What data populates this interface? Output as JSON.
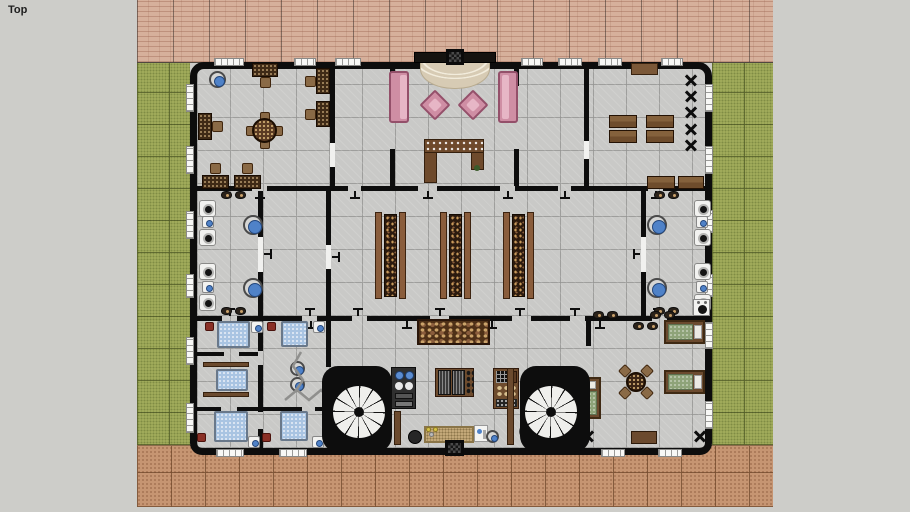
{
  "viewport": {
    "label": "Top",
    "background": "#cdcdc9"
  },
  "palette": {
    "background": "#cdcdc9",
    "wall": "#0d0d0d",
    "floor": "#c9c9c7",
    "grass": "#a6b05e",
    "brick": "#d6b09b",
    "paving": "#c69572",
    "sofa_pink": "#cf8ea4",
    "wood_brown": "#6b4a2e",
    "pool_blue": "#a9c4e2",
    "lounger_green": "#8ea379",
    "fixture_blue": "#4f82c8"
  },
  "plan": {
    "bands": {
      "brick": {
        "x": 137,
        "y": 0,
        "w": 636,
        "h": 63
      },
      "grass_left": {
        "x": 137,
        "y": 63,
        "w": 53,
        "h": 382
      },
      "grass_right": {
        "x": 712,
        "y": 63,
        "w": 61,
        "h": 382
      },
      "paving": {
        "x": 137,
        "y": 445,
        "w": 636,
        "h": 62
      }
    },
    "building": {
      "x": 190,
      "y": 62,
      "w": 522,
      "h": 393
    },
    "walls": [
      [
        197,
        186,
        55,
        5
      ],
      [
        267,
        186,
        81,
        5
      ],
      [
        361,
        186,
        57,
        5
      ],
      [
        437,
        186,
        63,
        5
      ],
      [
        515,
        186,
        43,
        5
      ],
      [
        571,
        186,
        77,
        5
      ],
      [
        663,
        186,
        42,
        5
      ],
      [
        197,
        316,
        25,
        5
      ],
      [
        237,
        316,
        65,
        5
      ],
      [
        317,
        316,
        35,
        5
      ],
      [
        367,
        316,
        63,
        5
      ],
      [
        449,
        316,
        63,
        5
      ],
      [
        531,
        316,
        39,
        5
      ],
      [
        585,
        316,
        67,
        5
      ],
      [
        667,
        316,
        38,
        5
      ],
      [
        330,
        67,
        5,
        76
      ],
      [
        330,
        167,
        5,
        19
      ],
      [
        390,
        62,
        5,
        24
      ],
      [
        390,
        149,
        5,
        37
      ],
      [
        514,
        62,
        5,
        24
      ],
      [
        514,
        149,
        5,
        37
      ],
      [
        584,
        67,
        5,
        74
      ],
      [
        584,
        159,
        5,
        27
      ],
      [
        258,
        191,
        5,
        46
      ],
      [
        258,
        272,
        5,
        44
      ],
      [
        326,
        191,
        5,
        54
      ],
      [
        326,
        269,
        5,
        47
      ],
      [
        641,
        191,
        5,
        46
      ],
      [
        641,
        272,
        5,
        44
      ],
      [
        326,
        321,
        5,
        46
      ],
      [
        586,
        321,
        5,
        25
      ],
      [
        258,
        321,
        5,
        30
      ],
      [
        258,
        365,
        5,
        47
      ],
      [
        258,
        429,
        5,
        21
      ],
      [
        197,
        352,
        27,
        4
      ],
      [
        239,
        352,
        19,
        4
      ],
      [
        197,
        407,
        24,
        4
      ],
      [
        237,
        407,
        65,
        4
      ],
      [
        315,
        407,
        15,
        4
      ]
    ],
    "door_gaps": [
      [
        330,
        143,
        5,
        24
      ],
      [
        258,
        237,
        5,
        35
      ],
      [
        326,
        245,
        5,
        24
      ],
      [
        641,
        237,
        5,
        35
      ],
      [
        584,
        141,
        5,
        18
      ]
    ],
    "windows": {
      "top": [
        [
          214,
          30
        ],
        [
          294,
          22
        ],
        [
          335,
          26
        ],
        [
          521,
          22
        ],
        [
          558,
          24
        ],
        [
          598,
          24
        ],
        [
          661,
          22
        ]
      ],
      "bottom": [
        [
          216,
          28
        ],
        [
          279,
          28
        ],
        [
          601,
          24
        ],
        [
          658,
          24
        ]
      ],
      "left": [
        [
          84,
          28
        ],
        [
          146,
          28
        ],
        [
          211,
          28
        ],
        [
          274,
          24
        ],
        [
          337,
          28
        ],
        [
          403,
          30
        ]
      ],
      "right": [
        [
          84,
          28
        ],
        [
          146,
          28
        ],
        [
          210,
          23
        ],
        [
          274,
          23
        ],
        [
          322,
          27
        ],
        [
          401,
          28
        ]
      ]
    },
    "door_marks": [
      [
        260,
        191,
        "s"
      ],
      [
        355,
        191,
        "s"
      ],
      [
        428,
        191,
        "s"
      ],
      [
        508,
        191,
        "s"
      ],
      [
        565,
        191,
        "s"
      ],
      [
        656,
        191,
        "s"
      ],
      [
        358,
        316,
        "n"
      ],
      [
        440,
        316,
        "n"
      ],
      [
        520,
        316,
        "n"
      ],
      [
        575,
        316,
        "n"
      ],
      [
        658,
        316,
        "n"
      ],
      [
        230,
        316,
        "n"
      ],
      [
        310,
        316,
        "n"
      ],
      [
        407,
        321,
        "s"
      ],
      [
        492,
        321,
        "s"
      ],
      [
        233,
        321,
        "s"
      ],
      [
        311,
        321,
        "s"
      ],
      [
        600,
        321,
        "s"
      ],
      [
        263,
        254,
        "e"
      ],
      [
        331,
        257,
        "e"
      ],
      [
        641,
        254,
        "w"
      ]
    ],
    "stairs": [
      {
        "x": 322,
        "y": 366,
        "w": 70,
        "h": 86,
        "fx": 37,
        "fy": 46
      },
      {
        "x": 520,
        "y": 366,
        "w": 70,
        "h": 86,
        "fx": 31,
        "fy": 46
      }
    ],
    "furniture": [
      {
        "n": "wash-basin",
        "s": "basin",
        "x": 209,
        "y": 71,
        "w": 17,
        "h": 17
      },
      {
        "n": "desk",
        "s": "desk",
        "x": 252,
        "y": 63,
        "w": 26,
        "h": 25,
        "f": "down"
      },
      {
        "n": "desk",
        "s": "desk",
        "x": 305,
        "y": 68,
        "w": 25,
        "h": 26,
        "f": "left"
      },
      {
        "n": "desk",
        "s": "desk",
        "x": 305,
        "y": 101,
        "w": 25,
        "h": 26,
        "f": "left"
      },
      {
        "n": "desk",
        "s": "desk",
        "x": 198,
        "y": 113,
        "w": 25,
        "h": 27,
        "f": "right"
      },
      {
        "n": "meeting-table",
        "s": "roundtable",
        "x": 246,
        "y": 112,
        "w": 37,
        "h": 37,
        "c": "#5a3a22"
      },
      {
        "n": "desk",
        "s": "desk",
        "x": 202,
        "y": 163,
        "w": 27,
        "h": 26,
        "f": "up"
      },
      {
        "n": "desk",
        "s": "desk",
        "x": 234,
        "y": 163,
        "w": 27,
        "h": 26,
        "f": "up"
      },
      {
        "n": "entrance-canopy",
        "s": "rect",
        "x": 414,
        "y": 52,
        "w": 82,
        "h": 11,
        "c": "#151310",
        "b": "#000000"
      },
      {
        "n": "entrance-porch",
        "s": "porch",
        "x": 420,
        "y": 63,
        "w": 70,
        "h": 26
      },
      {
        "n": "entrance-mat",
        "s": "mat",
        "x": 446,
        "y": 49,
        "w": 18,
        "h": 16
      },
      {
        "n": "sofa",
        "s": "sofa",
        "x": 389,
        "y": 71,
        "w": 20,
        "h": 52,
        "f": "right"
      },
      {
        "n": "sofa",
        "s": "sofa",
        "x": 498,
        "y": 71,
        "w": 20,
        "h": 52,
        "f": "left"
      },
      {
        "n": "armchair",
        "s": "chair45",
        "x": 424,
        "y": 94,
        "w": 22,
        "h": 22
      },
      {
        "n": "armchair",
        "s": "chair45",
        "x": 462,
        "y": 94,
        "w": 22,
        "h": 22
      },
      {
        "n": "reception-desk",
        "s": "reception",
        "x": 424,
        "y": 139,
        "w": 60,
        "h": 45
      },
      {
        "n": "side-table",
        "s": "rect",
        "x": 631,
        "y": 63,
        "w": 27,
        "h": 12,
        "c": "#7b5838",
        "b": "#38220f"
      },
      {
        "n": "table",
        "s": "plank",
        "x": 609,
        "y": 115,
        "w": 28,
        "h": 13
      },
      {
        "n": "table",
        "s": "plank",
        "x": 646,
        "y": 115,
        "w": 28,
        "h": 13
      },
      {
        "n": "table",
        "s": "plank",
        "x": 609,
        "y": 130,
        "w": 28,
        "h": 13
      },
      {
        "n": "table",
        "s": "plank",
        "x": 646,
        "y": 130,
        "w": 28,
        "h": 13
      },
      {
        "n": "chair-stack-marker",
        "s": "xmark",
        "x": 684,
        "y": 73,
        "w": 14,
        "h": 14
      },
      {
        "n": "chair-stack-marker",
        "s": "xmark",
        "x": 684,
        "y": 89,
        "w": 14,
        "h": 14
      },
      {
        "n": "chair-stack-marker",
        "s": "xmark",
        "x": 684,
        "y": 105,
        "w": 14,
        "h": 14
      },
      {
        "n": "chair-stack-marker",
        "s": "xmark",
        "x": 684,
        "y": 122,
        "w": 14,
        "h": 14
      },
      {
        "n": "chair-stack-marker",
        "s": "xmark",
        "x": 684,
        "y": 138,
        "w": 14,
        "h": 14
      },
      {
        "n": "table",
        "s": "plank",
        "x": 647,
        "y": 176,
        "w": 28,
        "h": 13
      },
      {
        "n": "table",
        "s": "plank",
        "x": 678,
        "y": 176,
        "w": 26,
        "h": 13
      },
      {
        "n": "toilet",
        "s": "toilet",
        "x": 199,
        "y": 200,
        "w": 17,
        "h": 17
      },
      {
        "n": "toilet",
        "s": "toilet",
        "x": 199,
        "y": 229,
        "w": 17,
        "h": 17
      },
      {
        "n": "toilet",
        "s": "toilet",
        "x": 199,
        "y": 263,
        "w": 17,
        "h": 17
      },
      {
        "n": "toilet",
        "s": "toilet",
        "x": 199,
        "y": 294,
        "w": 17,
        "h": 17
      },
      {
        "n": "sink",
        "s": "bluefix",
        "x": 202,
        "y": 216,
        "w": 12,
        "h": 12
      },
      {
        "n": "sink",
        "s": "bluefix",
        "x": 202,
        "y": 281,
        "w": 12,
        "h": 12
      },
      {
        "n": "wash-basin",
        "s": "basin",
        "x": 243,
        "y": 215,
        "w": 20,
        "h": 20
      },
      {
        "n": "wash-basin",
        "s": "basin",
        "x": 243,
        "y": 278,
        "w": 20,
        "h": 20
      },
      {
        "n": "slippers",
        "s": "slippers",
        "x": 221,
        "y": 191,
        "w": 26,
        "h": 8
      },
      {
        "n": "slippers",
        "s": "slippers",
        "x": 221,
        "y": 307,
        "w": 26,
        "h": 8
      },
      {
        "n": "toilet",
        "s": "toilet",
        "x": 694,
        "y": 200,
        "w": 17,
        "h": 17
      },
      {
        "n": "toilet",
        "s": "toilet",
        "x": 694,
        "y": 229,
        "w": 17,
        "h": 17
      },
      {
        "n": "toilet",
        "s": "toilet",
        "x": 694,
        "y": 263,
        "w": 17,
        "h": 17
      },
      {
        "n": "toilet",
        "s": "toilet",
        "x": 694,
        "y": 294,
        "w": 17,
        "h": 17
      },
      {
        "n": "sink",
        "s": "bluefix",
        "x": 696,
        "y": 216,
        "w": 12,
        "h": 12
      },
      {
        "n": "sink",
        "s": "bluefix",
        "x": 696,
        "y": 281,
        "w": 12,
        "h": 12
      },
      {
        "n": "wash-basin",
        "s": "basin",
        "x": 647,
        "y": 215,
        "w": 20,
        "h": 20
      },
      {
        "n": "wash-basin",
        "s": "basin",
        "x": 647,
        "y": 278,
        "w": 20,
        "h": 20
      },
      {
        "n": "slippers",
        "s": "slippers",
        "x": 654,
        "y": 191,
        "w": 26,
        "h": 8
      },
      {
        "n": "slippers",
        "s": "slippers",
        "x": 654,
        "y": 307,
        "w": 26,
        "h": 8
      },
      {
        "n": "stove",
        "s": "stove",
        "x": 693,
        "y": 299,
        "w": 17,
        "h": 17
      },
      {
        "n": "buffet-shelf",
        "s": "shelf",
        "x": 375,
        "y": 212,
        "w": 31,
        "h": 87
      },
      {
        "n": "buffet-shelf",
        "s": "shelf",
        "x": 440,
        "y": 212,
        "w": 31,
        "h": 87
      },
      {
        "n": "buffet-shelf",
        "s": "shelf",
        "x": 503,
        "y": 212,
        "w": 31,
        "h": 87
      },
      {
        "n": "buffet-table",
        "s": "buffet",
        "x": 417,
        "y": 319,
        "w": 73,
        "h": 26
      },
      {
        "n": "cooktop-unit",
        "s": "applL",
        "x": 391,
        "y": 367,
        "w": 25,
        "h": 42
      },
      {
        "n": "barrel-rack",
        "s": "barrels",
        "x": 435,
        "y": 368,
        "w": 39,
        "h": 29
      },
      {
        "n": "pantry-unit",
        "s": "applR",
        "x": 493,
        "y": 368,
        "w": 26,
        "h": 41
      },
      {
        "n": "counter",
        "s": "rect",
        "x": 394,
        "y": 411,
        "w": 7,
        "h": 34,
        "c": "#6b4a2e",
        "b": "#35200e"
      },
      {
        "n": "counter",
        "s": "rect",
        "x": 507,
        "y": 368,
        "w": 7,
        "h": 77,
        "c": "#6b4a2e",
        "b": "#35200e"
      },
      {
        "n": "pot",
        "s": "disc",
        "x": 408,
        "y": 430,
        "w": 14,
        "h": 14,
        "c": "#262626",
        "b": "#000000"
      },
      {
        "n": "counter-mat",
        "s": "matt",
        "x": 424,
        "y": 426,
        "w": 50,
        "h": 17
      },
      {
        "n": "bottles",
        "s": "bottles",
        "x": 426,
        "y": 427,
        "w": 12,
        "h": 10
      },
      {
        "n": "jug-tray",
        "s": "jug",
        "x": 474,
        "y": 425,
        "w": 14,
        "h": 17
      },
      {
        "n": "bowl",
        "s": "basin",
        "x": 486,
        "y": 430,
        "w": 13,
        "h": 13
      },
      {
        "n": "bowl",
        "s": "basin",
        "x": 519,
        "y": 425,
        "w": 13,
        "h": 13
      },
      {
        "n": "entrance-mat",
        "s": "mat",
        "x": 445,
        "y": 440,
        "w": 19,
        "h": 16
      },
      {
        "n": "spa-bed",
        "s": "pool",
        "x": 217,
        "y": 321,
        "w": 33,
        "h": 27
      },
      {
        "n": "spa-bed",
        "s": "pool",
        "x": 281,
        "y": 321,
        "w": 27,
        "h": 26
      },
      {
        "n": "fixture",
        "s": "bluefix",
        "x": 251,
        "y": 321,
        "w": 12,
        "h": 12
      },
      {
        "n": "fixture",
        "s": "bluefix",
        "x": 313,
        "y": 321,
        "w": 12,
        "h": 12
      },
      {
        "n": "stool",
        "s": "redstool",
        "x": 205,
        "y": 322,
        "w": 9,
        "h": 9
      },
      {
        "n": "stool",
        "s": "redstool",
        "x": 267,
        "y": 322,
        "w": 9,
        "h": 9
      },
      {
        "n": "bench",
        "s": "rect",
        "x": 203,
        "y": 362,
        "w": 46,
        "h": 5,
        "c": "#6b4a2e",
        "b": "#35200e"
      },
      {
        "n": "bench",
        "s": "rect",
        "x": 203,
        "y": 392,
        "w": 46,
        "h": 5,
        "c": "#6b4a2e",
        "b": "#35200e"
      },
      {
        "n": "massage-bed",
        "s": "pool",
        "x": 216,
        "y": 369,
        "w": 32,
        "h": 22
      },
      {
        "n": "stool",
        "s": "basin",
        "x": 290,
        "y": 361,
        "w": 15,
        "h": 15
      },
      {
        "n": "stool",
        "s": "basin",
        "x": 290,
        "y": 377,
        "w": 15,
        "h": 15
      },
      {
        "n": "plant-decor",
        "s": "zigzag",
        "x": 283,
        "y": 350,
        "w": 50,
        "h": 58
      },
      {
        "n": "spa-bed",
        "s": "pool",
        "x": 214,
        "y": 411,
        "w": 34,
        "h": 31
      },
      {
        "n": "spa-bed",
        "s": "pool",
        "x": 280,
        "y": 411,
        "w": 28,
        "h": 30
      },
      {
        "n": "stool",
        "s": "redstool",
        "x": 197,
        "y": 433,
        "w": 9,
        "h": 9
      },
      {
        "n": "stool",
        "s": "redstool",
        "x": 262,
        "y": 433,
        "w": 9,
        "h": 9
      },
      {
        "n": "fixture",
        "s": "bluefix",
        "x": 248,
        "y": 436,
        "w": 12,
        "h": 12
      },
      {
        "n": "fixture",
        "s": "bluefix",
        "x": 312,
        "y": 436,
        "w": 12,
        "h": 12
      },
      {
        "n": "slippers",
        "s": "slippers",
        "x": 593,
        "y": 311,
        "w": 24,
        "h": 8
      },
      {
        "n": "slippers",
        "s": "slippers",
        "x": 650,
        "y": 311,
        "w": 26,
        "h": 8
      },
      {
        "n": "slippers",
        "s": "slippers",
        "x": 633,
        "y": 322,
        "w": 24,
        "h": 8
      },
      {
        "n": "lounger",
        "s": "lounger",
        "x": 664,
        "y": 320,
        "w": 41,
        "h": 24,
        "f": "h"
      },
      {
        "n": "lounger",
        "s": "lounger",
        "x": 664,
        "y": 370,
        "w": 41,
        "h": 24,
        "f": "h"
      },
      {
        "n": "lounger",
        "s": "lounger",
        "x": 579,
        "y": 377,
        "w": 22,
        "h": 42,
        "f": "v"
      },
      {
        "n": "table-set",
        "s": "roundtable",
        "x": 620,
        "y": 366,
        "w": 32,
        "h": 32,
        "c": "#3a2414",
        "diag": true
      },
      {
        "n": "floor-marker",
        "s": "xmark",
        "x": 581,
        "y": 429,
        "w": 14,
        "h": 14
      },
      {
        "n": "floor-marker",
        "s": "xmark",
        "x": 693,
        "y": 429,
        "w": 14,
        "h": 14
      },
      {
        "n": "side-table",
        "s": "rect",
        "x": 631,
        "y": 431,
        "w": 26,
        "h": 13,
        "c": "#6b4a2e",
        "b": "#2c1a0a"
      }
    ]
  }
}
